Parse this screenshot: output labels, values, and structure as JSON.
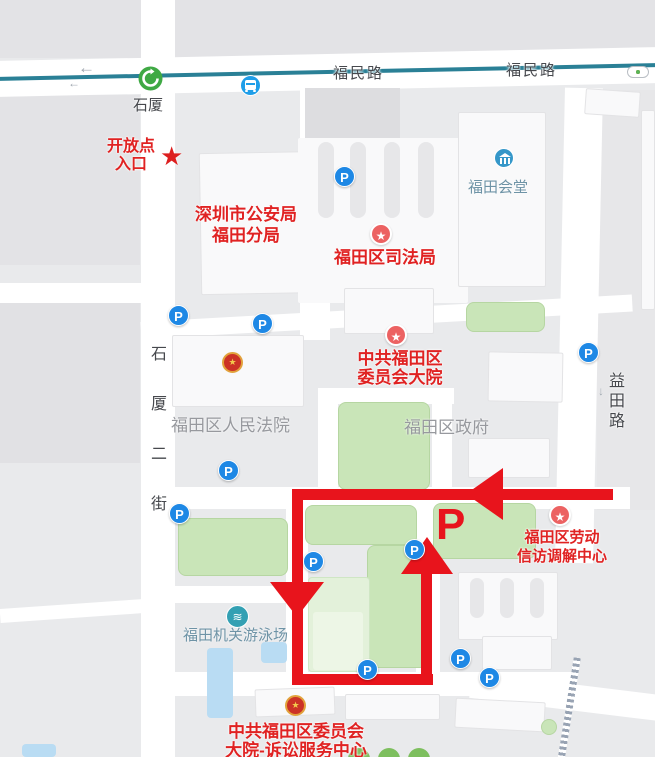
{
  "map": {
    "colors": {
      "route_red": "#e8141c",
      "transit_teal": "#2a8096",
      "parking_blue": "#1e88e5",
      "poi_pin_red": "#ec6262",
      "red_label": "#e02222",
      "green_area": "#c9e5b8",
      "pool_blue": "#b9dcf3"
    },
    "roads": {
      "fumin_label": "福民路",
      "shixia_2nd_chars": "石\n厦\n二\n街",
      "yitian_chars": "益\n田\n路",
      "direction_arrow": "←",
      "yitian_arrow": "↓"
    },
    "stations": {
      "metro_label": "石厦"
    },
    "pois": {
      "entrance": {
        "line1": "开放点",
        "line2": "入口",
        "star": "★"
      },
      "police": {
        "line1": "深圳市公安局",
        "line2": "福田分局"
      },
      "justice": {
        "line1": "福田区司法局"
      },
      "committee": {
        "line1": "中共福田区",
        "line2": "委员会大院"
      },
      "court": {
        "line1": "福田区人民法院"
      },
      "government": {
        "line1": "福田区政府"
      },
      "hall": {
        "line1": "福田会堂"
      },
      "labor": {
        "line1": "福田区劳动",
        "line2": "信访调解中心"
      },
      "swim": {
        "line1": "福田机关游泳场"
      },
      "litigation": {
        "line1": "中共福田区委员会",
        "line2": "大院-诉讼服务中心"
      }
    },
    "icons": {
      "parking_letter": "P",
      "poi_star": "★",
      "emblem_star": "★",
      "swim_glyph": "≋"
    },
    "route": {
      "parking_mark": "P"
    }
  }
}
